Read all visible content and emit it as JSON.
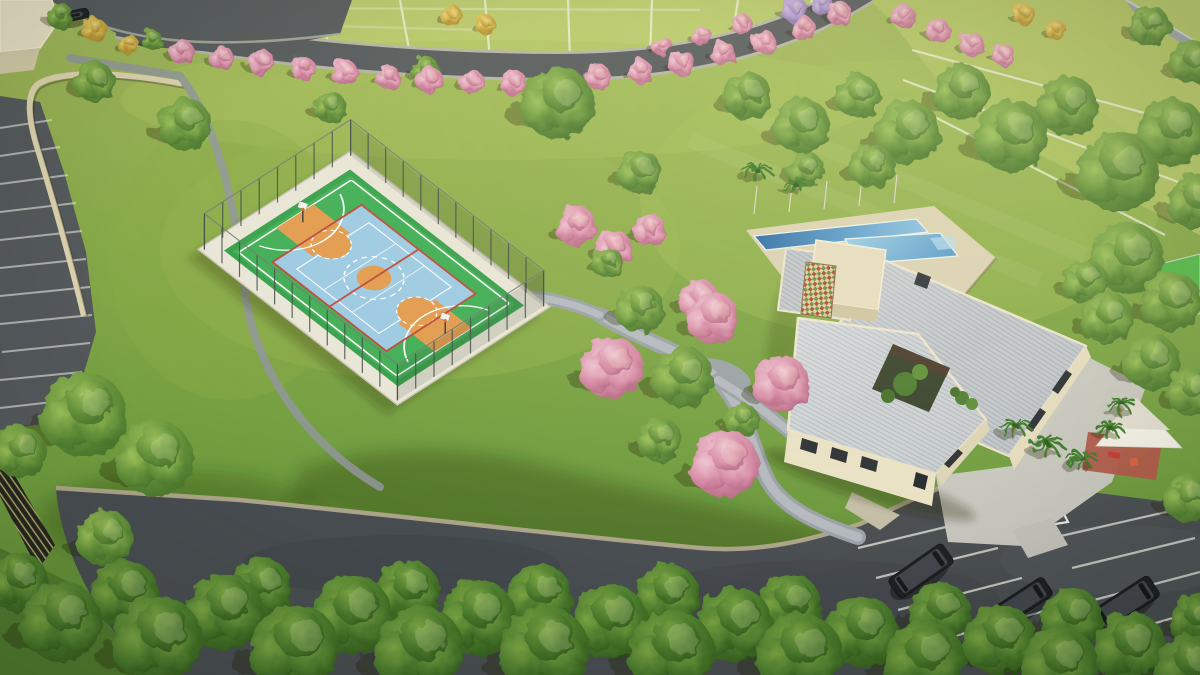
{
  "scene": {
    "type": "aerial-architectural-render",
    "setting": "residential condominium leisure area with sport court, clubhouse, pools and parking",
    "loading_zone_label": "CARGA E DESCARGA",
    "palette": {
      "grass": "#7fa544",
      "grassLight": "#b9ca6b",
      "grassDark": "#5a8634",
      "asphalt": "#53585b",
      "asphaltDark": "#474c50",
      "curb": "#b3ab90",
      "path": "#a4aab0",
      "courtGreen": "#3aa84f",
      "courtBlue": "#9ccae4",
      "courtOrange": "#e29b4e",
      "courtRed": "#c04838",
      "lineWhite": "#ffffff",
      "roof": "#c3c8cd",
      "roofRib": "#a9aeb5",
      "cream": "#e9e1c4",
      "deck": "#dbd2b4",
      "poolDeep": "#2e6ba5",
      "poolLight": "#9fd0e8",
      "treeGreen": "#5d8d33",
      "treeDarkGreen": "#3f6b26",
      "treePink": "#d68aa6",
      "treeYellow": "#d8b84a",
      "treePurple": "#a98fc9",
      "palmGreen": "#3e7a2a",
      "shadeSail": "#f2efe6",
      "playgroundFloor": "#b05648",
      "wallGray": "#9aa0a4",
      "carDark": "#1c1e22"
    },
    "features": [
      "multi-sport court",
      "chain-link court fence",
      "clubhouse with ribbed metal roofs",
      "lap pool",
      "leisure pool",
      "pool deck",
      "internal courtyard",
      "decorative lattice panel",
      "shade-sail playground",
      "walking paths",
      "visitor parking",
      "loading zone marking",
      "residential lots",
      "pink flowering trees",
      "palm trees",
      "perimeter wall",
      "retaining wall"
    ],
    "court": {
      "sports": [
        "basketball",
        "futsal",
        "volleyball"
      ]
    },
    "trees": [
      [
        182,
        52,
        12,
        "p"
      ],
      [
        222,
        58,
        12,
        "p"
      ],
      [
        262,
        63,
        13,
        "p"
      ],
      [
        303,
        68,
        12,
        "p"
      ],
      [
        345,
        73,
        13,
        "p"
      ],
      [
        388,
        77,
        12,
        "p"
      ],
      [
        430,
        80,
        13,
        "p"
      ],
      [
        472,
        82,
        12,
        "p"
      ],
      [
        514,
        83,
        13,
        "p"
      ],
      [
        556,
        81,
        12,
        "p"
      ],
      [
        598,
        77,
        13,
        "p"
      ],
      [
        640,
        71,
        12,
        "p"
      ],
      [
        682,
        63,
        13,
        "p"
      ],
      [
        723,
        53,
        12,
        "p"
      ],
      [
        764,
        42,
        12,
        "p"
      ],
      [
        803,
        28,
        12,
        "p"
      ],
      [
        840,
        14,
        12,
        "p"
      ],
      [
        662,
        46,
        10,
        "p"
      ],
      [
        702,
        36,
        10,
        "p"
      ],
      [
        742,
        24,
        10,
        "p"
      ],
      [
        903,
        16,
        12,
        "p"
      ],
      [
        938,
        30,
        12,
        "p"
      ],
      [
        972,
        44,
        12,
        "p"
      ],
      [
        1004,
        55,
        11,
        "p"
      ],
      [
        452,
        16,
        11,
        "y"
      ],
      [
        486,
        25,
        10,
        "y"
      ],
      [
        95,
        30,
        12,
        "y"
      ],
      [
        1024,
        14,
        11,
        "y"
      ],
      [
        1056,
        30,
        10,
        "y"
      ],
      [
        128,
        44,
        10,
        "y"
      ],
      [
        795,
        10,
        13,
        "v"
      ],
      [
        822,
        4,
        11,
        "v"
      ],
      [
        60,
        16,
        13,
        "g"
      ],
      [
        152,
        40,
        10,
        "g"
      ],
      [
        95,
        82,
        20,
        "g"
      ],
      [
        185,
        124,
        26,
        "g"
      ],
      [
        330,
        107,
        16,
        "g"
      ],
      [
        425,
        70,
        14,
        "g"
      ],
      [
        558,
        103,
        36,
        "g"
      ],
      [
        640,
        172,
        22,
        "g"
      ],
      [
        608,
        262,
        15,
        "g"
      ],
      [
        576,
        226,
        20,
        "p"
      ],
      [
        614,
        248,
        18,
        "p"
      ],
      [
        650,
        230,
        16,
        "p"
      ],
      [
        700,
        300,
        20,
        "p"
      ],
      [
        640,
        309,
        24,
        "g"
      ],
      [
        683,
        377,
        30,
        "g"
      ],
      [
        612,
        368,
        31,
        "p"
      ],
      [
        713,
        318,
        26,
        "p"
      ],
      [
        782,
        384,
        28,
        "p"
      ],
      [
        725,
        464,
        34,
        "p"
      ],
      [
        660,
        440,
        22,
        "g"
      ],
      [
        742,
        420,
        17,
        "g"
      ],
      [
        85,
        415,
        42,
        "g"
      ],
      [
        155,
        458,
        38,
        "g"
      ],
      [
        105,
        538,
        28,
        "g"
      ],
      [
        20,
        452,
        26,
        "g"
      ],
      [
        748,
        96,
        24,
        "g"
      ],
      [
        802,
        126,
        28,
        "g"
      ],
      [
        858,
        96,
        22,
        "g"
      ],
      [
        908,
        132,
        32,
        "g"
      ],
      [
        962,
        92,
        28,
        "g"
      ],
      [
        1012,
        136,
        36,
        "g"
      ],
      [
        1068,
        106,
        30,
        "g"
      ],
      [
        1118,
        172,
        40,
        "g"
      ],
      [
        1172,
        132,
        34,
        "g"
      ],
      [
        1196,
        202,
        28,
        "g"
      ],
      [
        872,
        166,
        22,
        "g"
      ],
      [
        806,
        170,
        18,
        "g"
      ],
      [
        1128,
        258,
        36,
        "g"
      ],
      [
        1172,
        302,
        30,
        "g"
      ],
      [
        1108,
        318,
        26,
        "g"
      ],
      [
        1152,
        362,
        28,
        "g"
      ],
      [
        1192,
        392,
        24,
        "g"
      ],
      [
        1086,
        282,
        22,
        "g"
      ],
      [
        1150,
        26,
        20,
        "g"
      ],
      [
        1192,
        62,
        22,
        "g"
      ],
      [
        1188,
        498,
        24,
        "g"
      ],
      [
        18,
        582,
        30,
        "d"
      ],
      [
        62,
        622,
        40,
        "d"
      ],
      [
        125,
        594,
        34,
        "d"
      ],
      [
        158,
        640,
        44,
        "d"
      ],
      [
        225,
        612,
        38,
        "d"
      ],
      [
        295,
        648,
        44,
        "d"
      ],
      [
        262,
        588,
        30,
        "d"
      ],
      [
        352,
        615,
        40,
        "d"
      ],
      [
        420,
        650,
        44,
        "d"
      ],
      [
        408,
        592,
        32,
        "d"
      ],
      [
        478,
        618,
        38,
        "d"
      ],
      [
        545,
        650,
        44,
        "d"
      ],
      [
        540,
        596,
        32,
        "d"
      ],
      [
        610,
        622,
        38,
        "d"
      ],
      [
        672,
        652,
        42,
        "d"
      ],
      [
        668,
        596,
        32,
        "d"
      ],
      [
        735,
        625,
        38,
        "d"
      ],
      [
        800,
        655,
        42,
        "d"
      ],
      [
        790,
        606,
        32,
        "d"
      ],
      [
        862,
        632,
        36,
        "d"
      ],
      [
        925,
        660,
        40,
        "d"
      ],
      [
        940,
        612,
        30,
        "d"
      ],
      [
        1000,
        640,
        36,
        "d"
      ],
      [
        1060,
        665,
        38,
        "d"
      ],
      [
        1072,
        618,
        30,
        "d"
      ],
      [
        1130,
        648,
        36,
        "d"
      ],
      [
        1190,
        668,
        34,
        "d"
      ],
      [
        1196,
        620,
        26,
        "d"
      ],
      [
        757,
        170,
        15,
        "m"
      ],
      [
        795,
        184,
        13,
        "m"
      ],
      [
        1016,
        426,
        16,
        "m"
      ],
      [
        1048,
        444,
        17,
        "m"
      ],
      [
        1082,
        458,
        16,
        "m"
      ],
      [
        1110,
        428,
        14,
        "m"
      ],
      [
        1122,
        404,
        15,
        "m"
      ]
    ],
    "cars": [
      [
        76,
        15,
        -12,
        26,
        10
      ],
      [
        921,
        571,
        -35,
        66,
        24
      ],
      [
        1022,
        602,
        -33,
        62,
        22
      ],
      [
        1125,
        604,
        -33,
        70,
        25
      ]
    ]
  }
}
